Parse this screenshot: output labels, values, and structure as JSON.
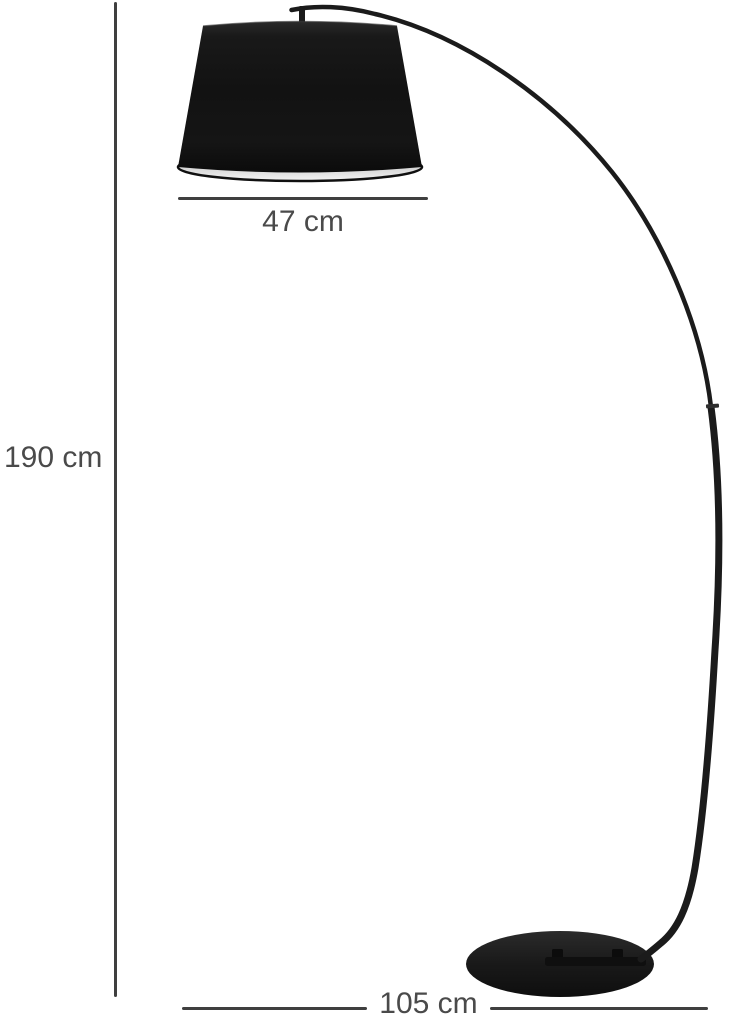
{
  "figure": {
    "type": "product-dimension-diagram",
    "subject": "arc floor lamp with tapered drum shade and round base",
    "background": "#ffffff"
  },
  "colors": {
    "dimension_line": "#3f3f3f",
    "dimension_text": "#4a4a4a",
    "lamp_shade": "#141414",
    "lamp_frame": "#1a1a1a",
    "shade_inner_rim": "#e9e9e9",
    "base": "#1a1a1a"
  },
  "dimensions": {
    "height": {
      "label": "190 cm"
    },
    "shade_width": {
      "label": "47 cm"
    },
    "base_width": {
      "label": "105 cm"
    }
  }
}
